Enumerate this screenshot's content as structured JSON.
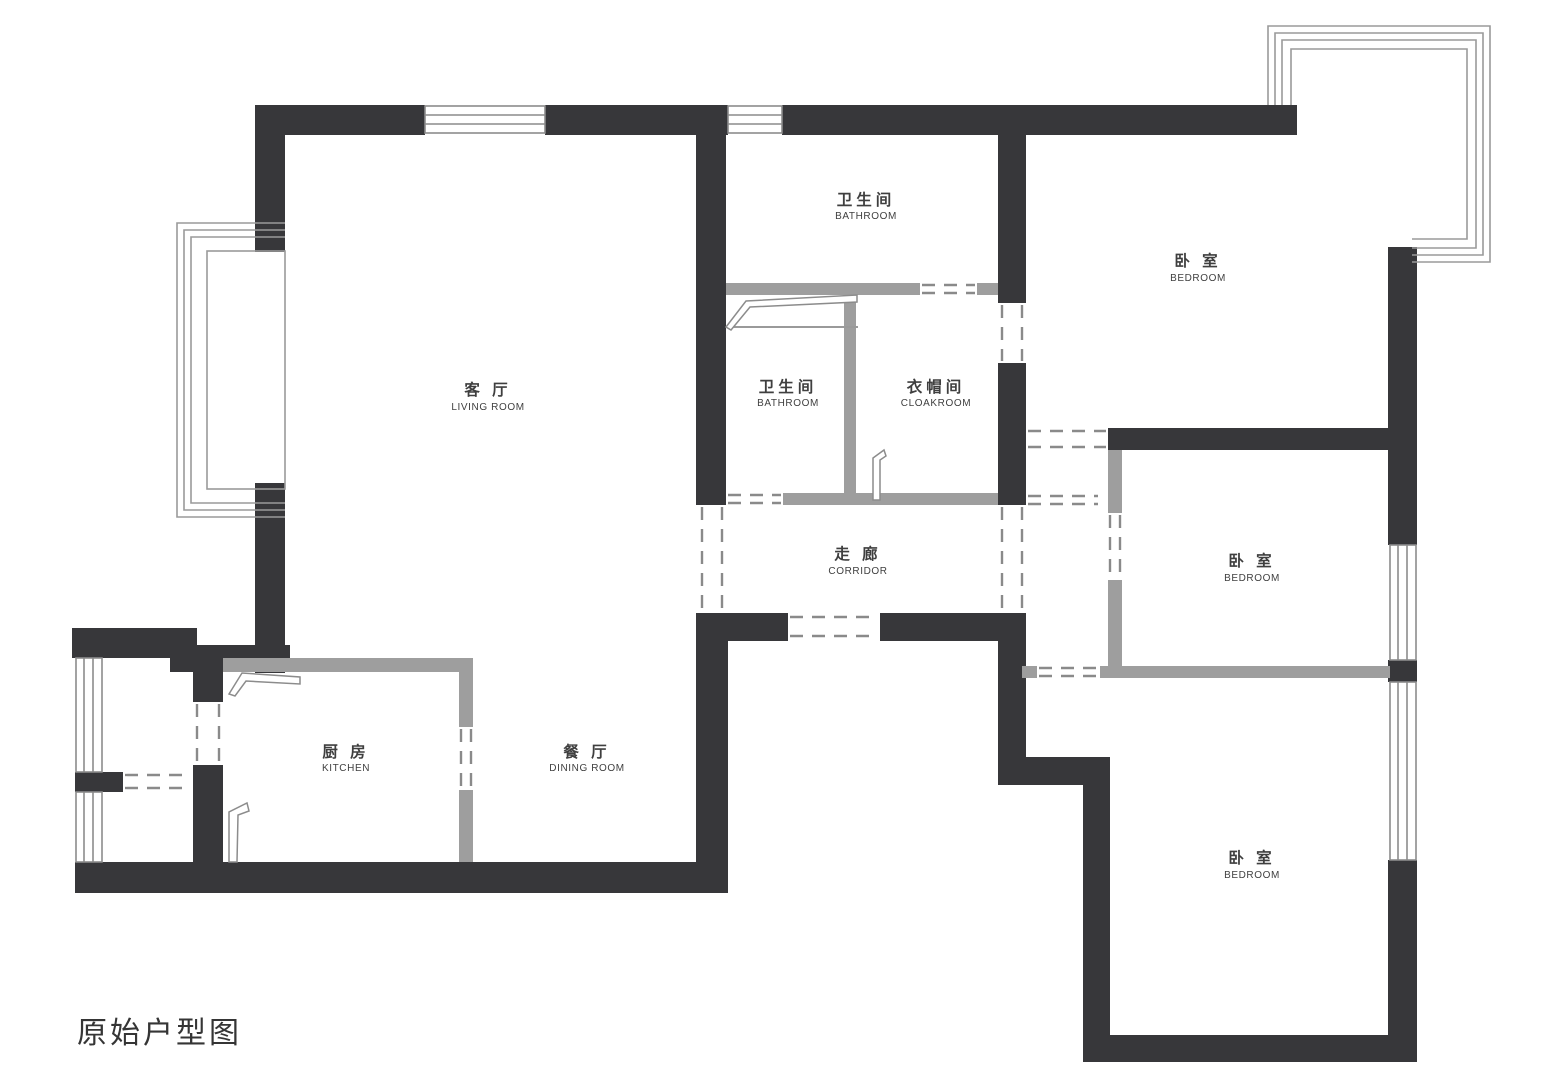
{
  "title": "原始户型图",
  "colors": {
    "wall_structural": "#37373a",
    "wall_partition": "#9e9e9e",
    "window_line": "#8c8c8c",
    "text": "#3f3f3f",
    "background": "#ffffff"
  },
  "rooms": [
    {
      "id": "living-room",
      "cn": "客 厅",
      "en": "LIVING ROOM"
    },
    {
      "id": "bathroom-top",
      "cn": "卫生间",
      "en": "BATHROOM"
    },
    {
      "id": "bathroom-middle",
      "cn": "卫生间",
      "en": "BATHROOM"
    },
    {
      "id": "cloakroom",
      "cn": "衣帽间",
      "en": "CLOAKROOM"
    },
    {
      "id": "bedroom-top-right",
      "cn": "卧 室",
      "en": "BEDROOM"
    },
    {
      "id": "bedroom-middle-right",
      "cn": "卧 室",
      "en": "BEDROOM"
    },
    {
      "id": "bedroom-bottom-right",
      "cn": "卧 室",
      "en": "BEDROOM"
    },
    {
      "id": "corridor",
      "cn": "走 廊",
      "en": "CORRIDOR"
    },
    {
      "id": "kitchen",
      "cn": "厨 房",
      "en": "KITCHEN"
    },
    {
      "id": "dining-room",
      "cn": "餐 厅",
      "en": "DINING ROOM"
    }
  ]
}
